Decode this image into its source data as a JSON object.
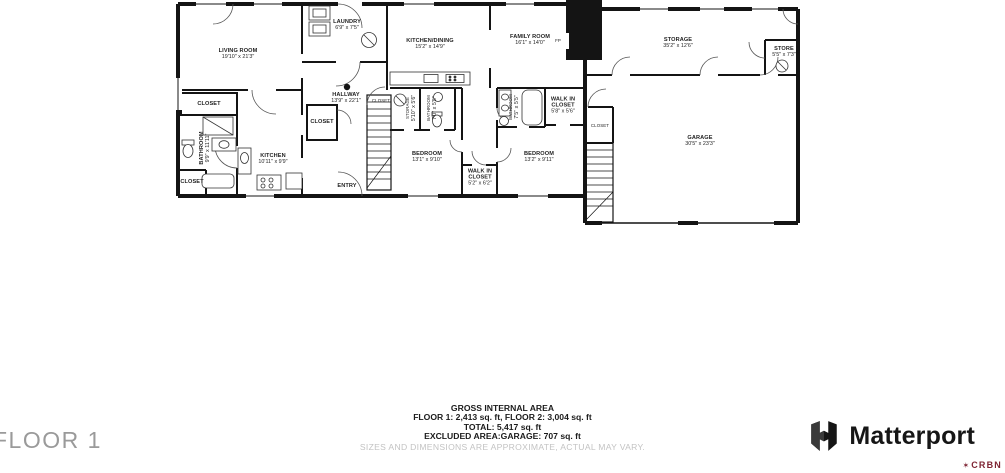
{
  "floor_label": "FLOOR 1",
  "footer": {
    "title": "GROSS INTERNAL AREA",
    "line1": "FLOOR 1: 2,413 sq. ft, FLOOR 2: 3,004 sq. ft",
    "line2": "TOTAL: 5,417 sq. ft",
    "line3": "EXCLUDED AREA:GARAGE: 707 sq. ft",
    "disclaimer": "SIZES AND DIMENSIONS ARE APPROXIMATE, ACTUAL MAY VARY."
  },
  "brand": {
    "name": "Matterport",
    "watermark": "CRBN",
    "watermark_icon": "✶"
  },
  "colors": {
    "wall": "#141414",
    "label": "#1f1f1f",
    "disclaimer_gray": "#c3c3c3",
    "floor_gray": "#9a9a9a",
    "watermark_red": "#7e2433"
  },
  "rooms": [
    {
      "name": "LIVING ROOM",
      "dims": "19'10\" x 21'3\""
    },
    {
      "name": "CLOSET",
      "dims": ""
    },
    {
      "name": "BATHROOM",
      "dims": "9'9\" x 11'11\""
    },
    {
      "name": "CLOSET",
      "dims": ""
    },
    {
      "name": "KITCHEN",
      "dims": "10'11\" x 9'9\""
    },
    {
      "name": "LAUNDRY",
      "dims": "6'9\" x 7'5\""
    },
    {
      "name": "HALLWAY",
      "dims": "13'9\" x 22'1\""
    },
    {
      "name": "CLOSET",
      "dims": ""
    },
    {
      "name": "CLOSET",
      "dims": ""
    },
    {
      "name": "ENTRY",
      "dims": ""
    },
    {
      "name": "KITCHEN/DINING",
      "dims": "15'2\" x 14'9\""
    },
    {
      "name": "FAMILY ROOM",
      "dims": "16'1\" x 14'0\""
    },
    {
      "name": "FP",
      "dims": ""
    },
    {
      "name": "STORAGE",
      "dims": "5'10\" x 5'6\""
    },
    {
      "name": "BATHROOM",
      "dims": "7'0\" x 5'5\""
    },
    {
      "name": "BEDROOM",
      "dims": "13'1\" x 9'10\""
    },
    {
      "name": "WALK IN CLOSET",
      "dims": "5'2\" x 6'2\""
    },
    {
      "name": "BATHROOM",
      "dims": "7'5\" x 5'5\""
    },
    {
      "name": "WALK IN CLOSET",
      "dims": "5'8\" x 5'6\""
    },
    {
      "name": "BEDROOM",
      "dims": "13'2\" x 9'11\""
    },
    {
      "name": "CLOSET",
      "dims": ""
    },
    {
      "name": "STORAGE",
      "dims": "35'2\" x 12'6\""
    },
    {
      "name": "STORE",
      "dims": "5'5\" x 7'3\""
    },
    {
      "name": "GARAGE",
      "dims": "30'5\" x 23'3\""
    }
  ]
}
